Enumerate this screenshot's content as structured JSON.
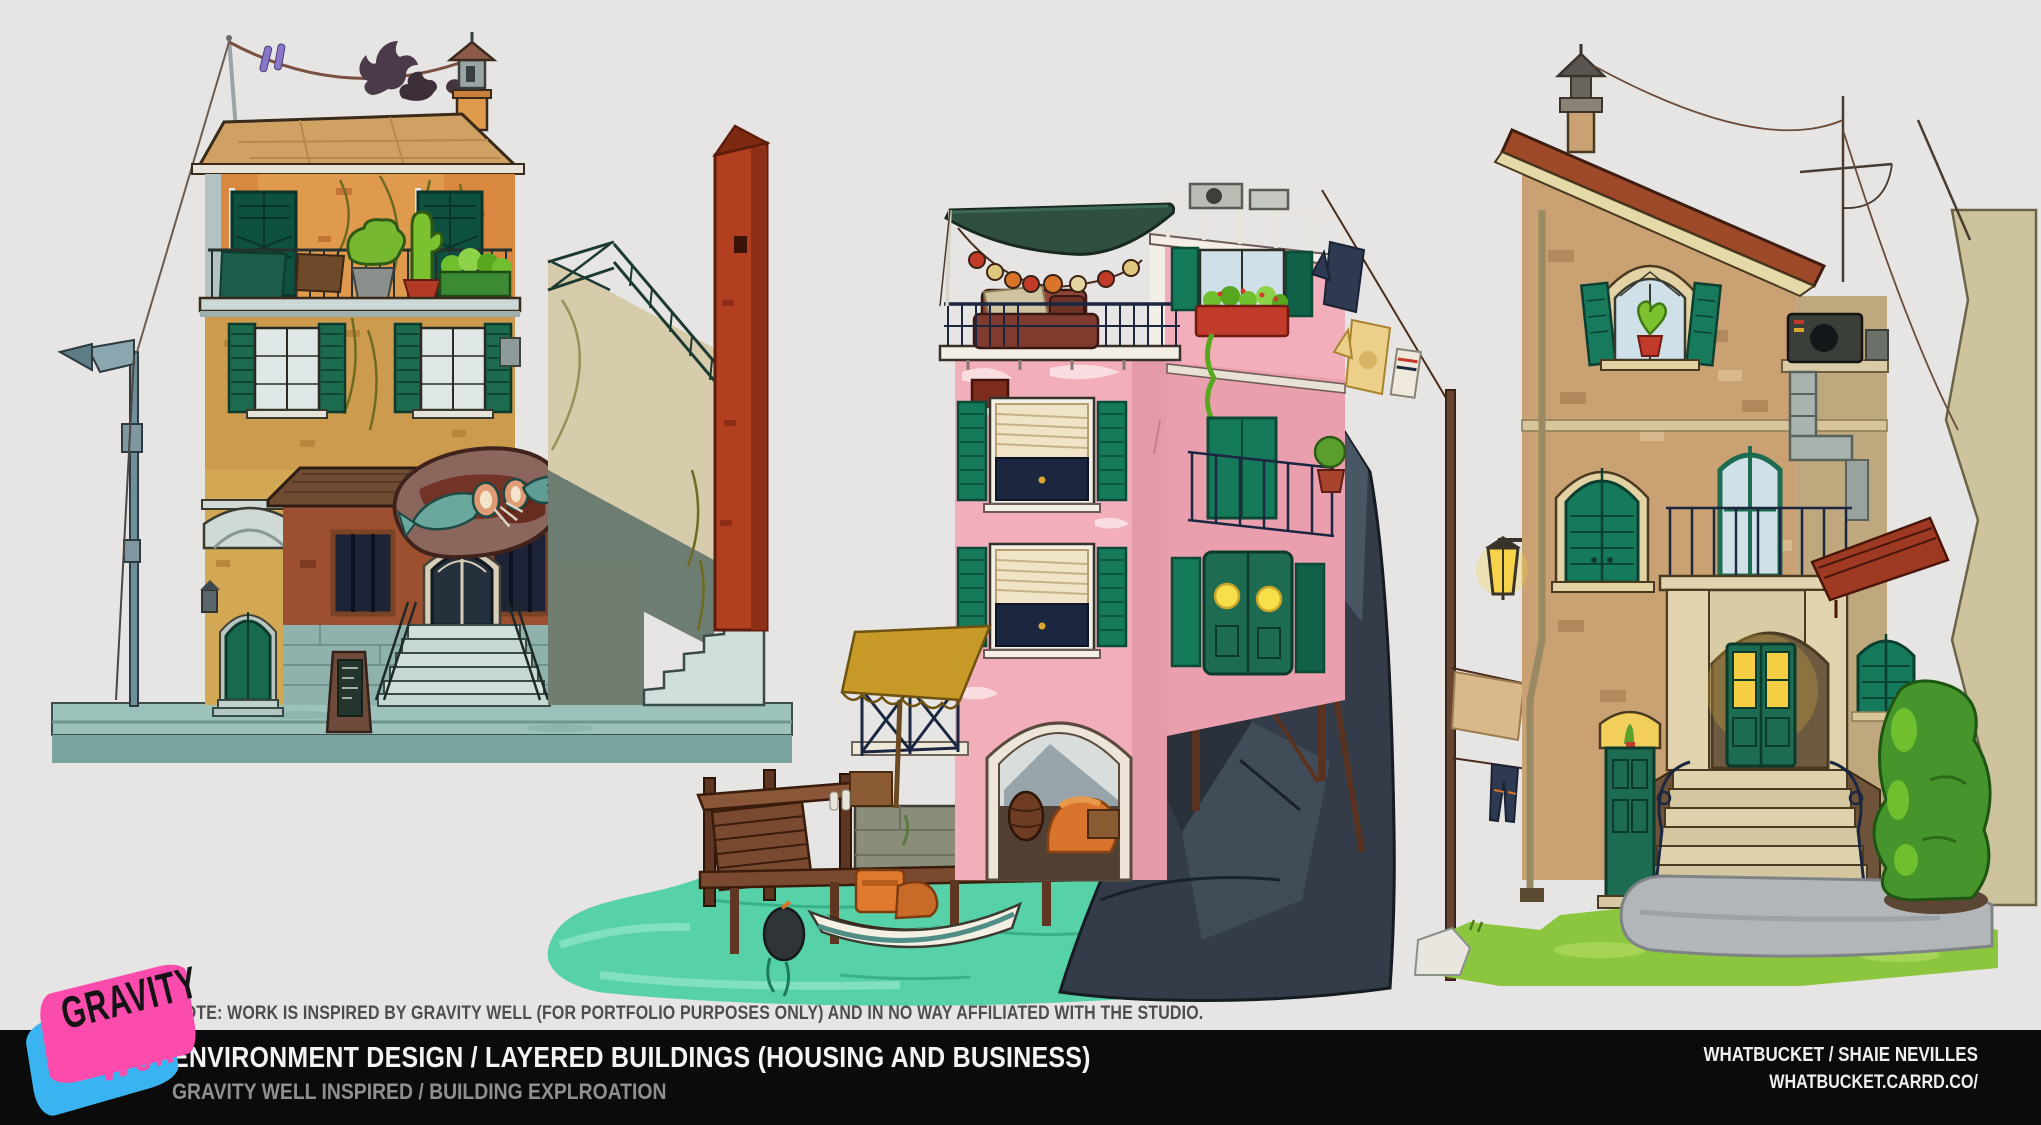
{
  "page": {
    "width": 2041,
    "height": 1125,
    "background": "#e6e5e3",
    "footer_background": "#0b0b0b"
  },
  "note_bar": {
    "text": "NOTE: WORK IS INSPIRED BY GRAVITY WELL (FOR PORTFOLIO PURPOSES ONLY) AND IN NO WAY AFFILIATED WITH THE STUDIO."
  },
  "footer": {
    "title": "ENVIRONMENT DESIGN / LAYERED BUILDINGS (HOUSING AND BUSINESS)",
    "subtitle": "GRAVITY WELL INSPIRED / BUILDING EXPLROATION",
    "artist": "WHATBUCKET / SHAIE NEVILLES",
    "website": "WHATBUCKET.CARRD.CO/"
  },
  "logo": {
    "word1": "GRAVITY",
    "word2": "Well",
    "pink": "#fb4cae",
    "blue": "#3ab4f0"
  },
  "artwork": {
    "description": "Three layered-building concept paintings",
    "buildings": [
      {
        "id": "left",
        "label": "brick tavern with fish sign and street lamp"
      },
      {
        "id": "middle",
        "label": "pink canal house over water with boat and dock"
      },
      {
        "id": "right",
        "label": "tan stone house with entrance stairs and garden"
      }
    ],
    "palette": {
      "roof_tan": "#cfa263",
      "wall_orange": "#d8893f",
      "wall_mustard": "#cd9b4e",
      "wall_pink": "#f3aebb",
      "wall_brick_tan": "#c9a172",
      "shutter_green": "#157a5a",
      "door_green": "#1d6b50",
      "water_turquoise": "#57d1a7",
      "street_teal": "#9cc2bb",
      "rock_dark": "#343c49",
      "grass_green": "#8cc63e",
      "awning_dark_green": "#2f5040",
      "awning_yellow": "#c79a27",
      "sign_maroon": "#6e2a1c",
      "fish_teal": "#6aa89e",
      "lit_window_yellow": "#f5c63a"
    }
  }
}
